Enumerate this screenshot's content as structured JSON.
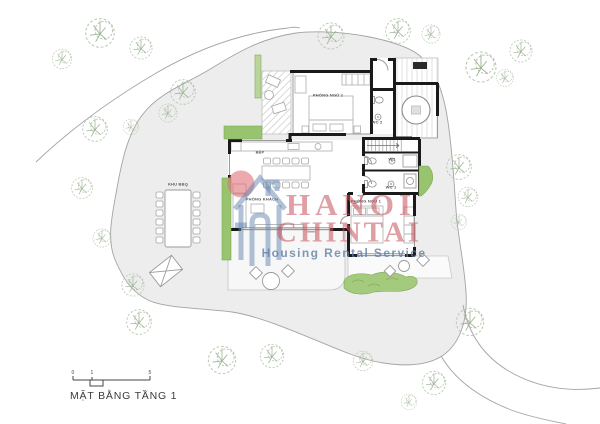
{
  "plan": {
    "title": "MẶT BẰNG TẦNG 1",
    "scale_bar": {
      "ticks": [
        "0",
        "1",
        "5"
      ]
    }
  },
  "rooms": {
    "bedroom2": "PHÒNG NGỦ 2",
    "wc2": "WC 2",
    "kitchen": "BẾP",
    "living": "PHÒNG KHÁCH",
    "wc": "WC",
    "wc1": "WC 1",
    "bedroom1": "PHÒNG NGỦ 1",
    "bbq": "KHU BBQ"
  },
  "watermark": {
    "brand_line1": "HANOI",
    "brand_line2": "CHINTAI",
    "tagline": "Housing Rental Service"
  },
  "icons": {
    "tree": "tree-icon",
    "house_logo": "house-logo-icon",
    "sun": "sun-circle-icon"
  },
  "colors": {
    "wall_black": "#1a1a1a",
    "site_gray": "#ededed",
    "boundary_gray": "#a3a3a3",
    "tree_green": "#b4c6ac",
    "planter_green": "#98c36f",
    "planter_light_green": "#bad49b",
    "pond_green": "#a4ca7e",
    "watermark_pink": "rgba(197,80,90,0.55)",
    "watermark_blue": "rgba(95,126,168,0.8)",
    "logo_blue": "rgba(100,132,176,0.5)",
    "logo_sun_pink": "rgba(223,111,120,0.6)"
  }
}
